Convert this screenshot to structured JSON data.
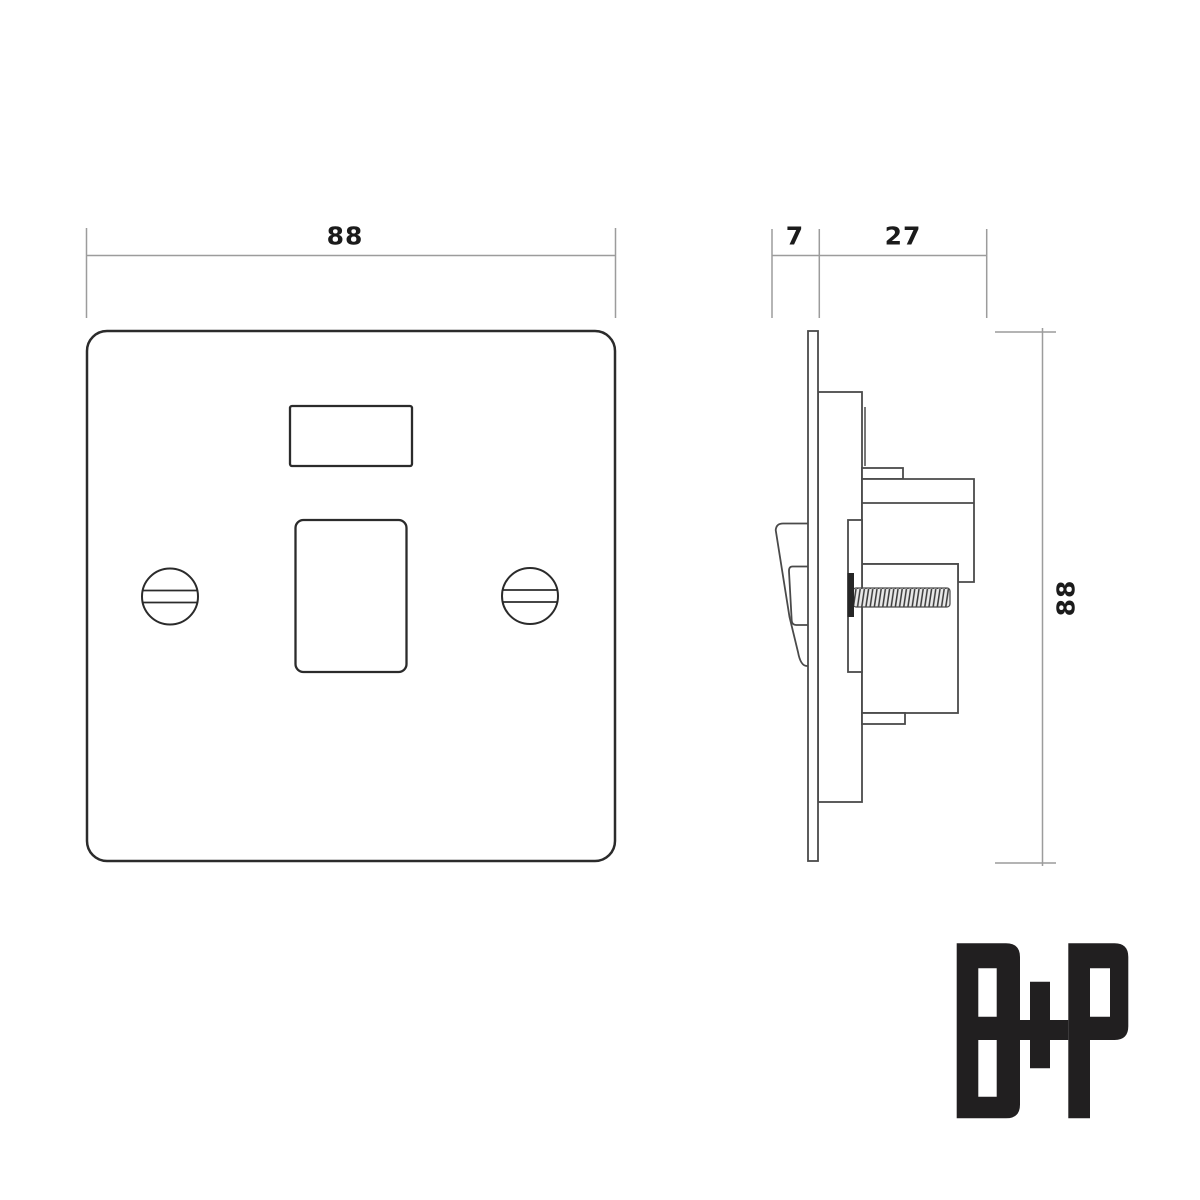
{
  "drawing": {
    "description": "Technical dimension drawing of a flat-plate switched fused spur / switch: front view and side profile view",
    "dimensions": {
      "front_width": "88",
      "bezel_depth": "7",
      "mechanism_depth": "27",
      "plate_height": "88"
    },
    "logo": {
      "text": "B+P"
    },
    "colors": {
      "background": "#ffffff",
      "front_outline": "#2b2b2b",
      "side_outline": "#4a4a4a",
      "dimension_line": "#9c9c9c",
      "label_text": "#1b1b1b",
      "logo": "#211f20",
      "thread_fill": "#3a3a3a"
    }
  }
}
